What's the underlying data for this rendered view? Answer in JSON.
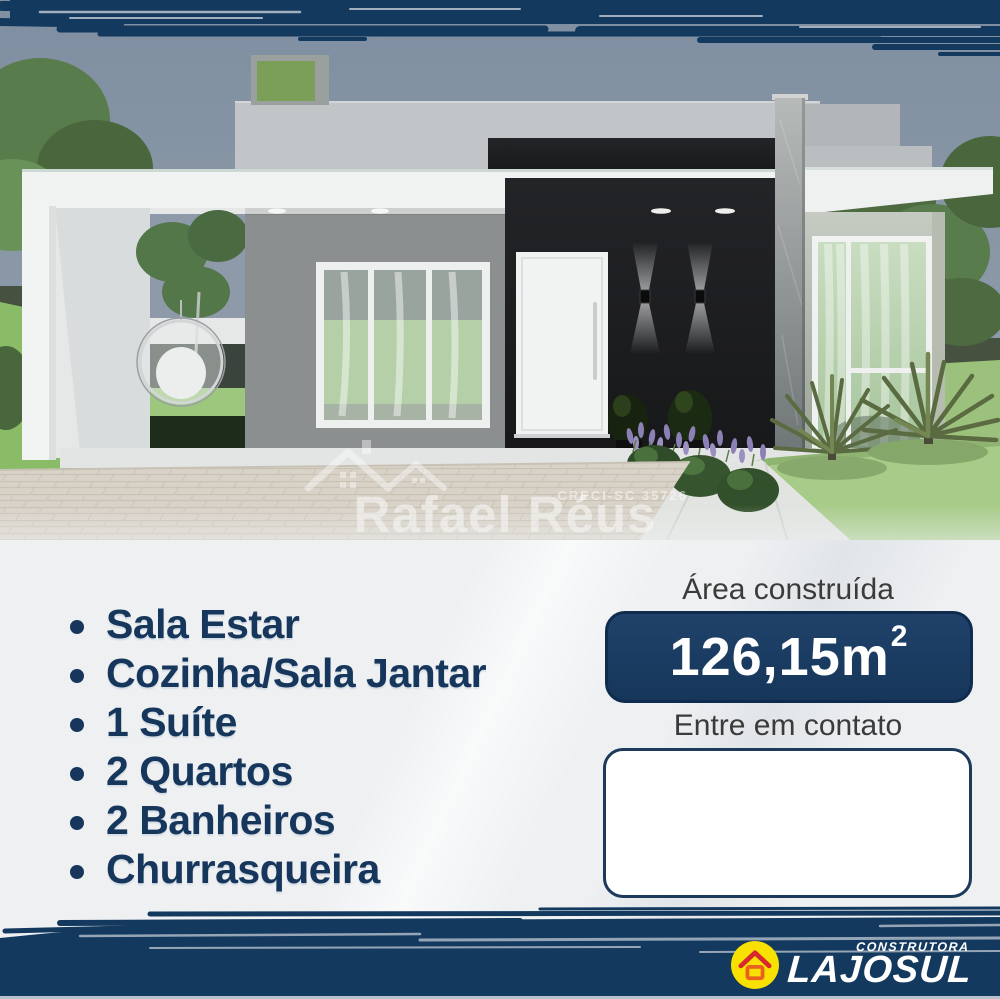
{
  "poster": {
    "colors": {
      "band_navy": "#14395e",
      "badge_navy": "#1a3a60",
      "list_text_navy": "#16365c",
      "label_gray": "#3b3b3b",
      "bottom_strip": "#b7c1cc",
      "logo_yellow": "#f8e000",
      "logo_red": "#d7282f",
      "logo_orange": "#e8611f"
    },
    "watermark": {
      "icon": "roof-logo-icon",
      "creci": "CRECI-SC 35726",
      "name": "Rafael Réus",
      "subtitle": "AVALIADOR E CORRETOR DE IMÓVEIS"
    },
    "features": {
      "items": [
        "Sala Estar",
        "Cozinha/Sala Jantar",
        "1 Suíte",
        "2 Quartos",
        "2 Banheiros",
        "Churrasqueira"
      ]
    },
    "area": {
      "label": "Área construída",
      "value": "126,15m",
      "superscript": "2"
    },
    "contact": {
      "label": "Entre em contato"
    },
    "brand": {
      "tagline": "CONSTRUTORA",
      "name": "LAJOSUL",
      "icon": "house-icon"
    }
  }
}
